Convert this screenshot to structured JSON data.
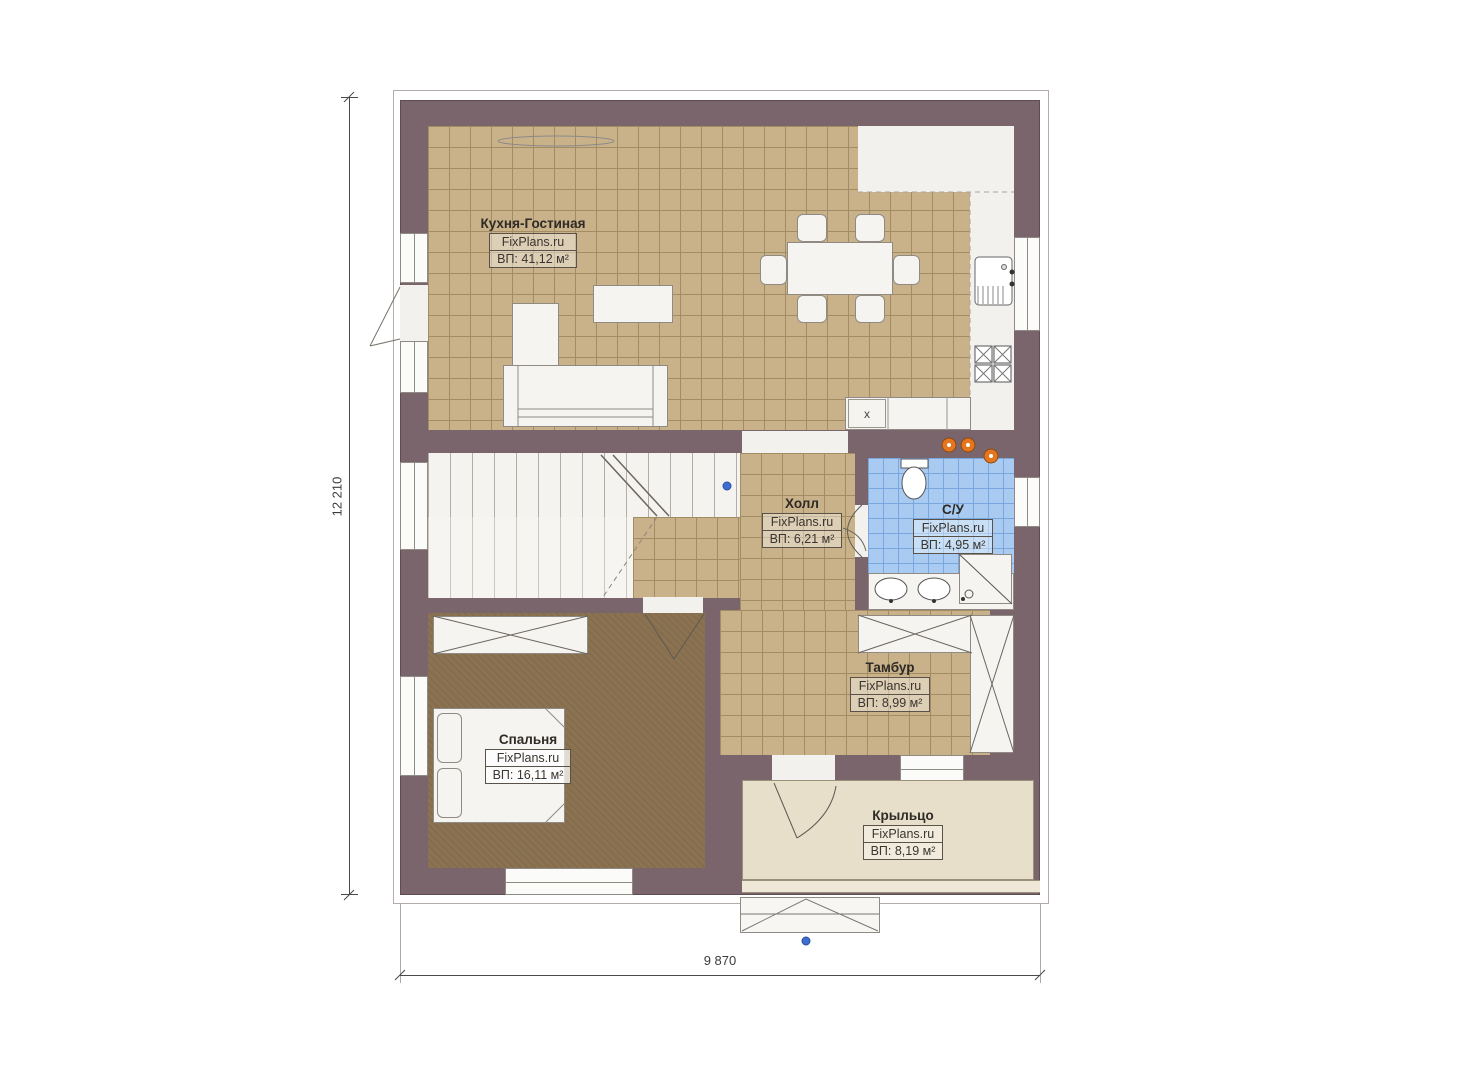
{
  "brand": "FixPlans.ru",
  "dimension_labels": {
    "vertical": "12 210",
    "horizontal": "9 870"
  },
  "kitchen_counter_mark": "x",
  "rooms": [
    {
      "key": "kitchen-living",
      "name": "Кухня-Гостиная",
      "area": "ВП: 41,12 м²"
    },
    {
      "key": "hall",
      "name": "Холл",
      "area": "ВП: 6,21 м²"
    },
    {
      "key": "bathroom",
      "name": "С/У",
      "area": "ВП: 4,95 м²"
    },
    {
      "key": "vestibule",
      "name": "Тамбур",
      "area": "ВП: 8,99 м²"
    },
    {
      "key": "bedroom",
      "name": "Спальня",
      "area": "ВП: 16,11 м²"
    },
    {
      "key": "porch",
      "name": "Крыльцо",
      "area": "ВП: 8,19 м²"
    }
  ],
  "colors": {
    "wall": "#7b656c",
    "floor_tile": "#c9b189",
    "tile_grid": "#a28c63",
    "bedroom_floor": "#8b7352",
    "bathroom_tile": "#a9cbf1",
    "bathroom_grid": "#78a6dd",
    "porch_floor": "#e8dfca",
    "furniture": "#f5f4f1",
    "marker_orange": "#e4761f",
    "marker_blue": "#3c6fd1"
  }
}
